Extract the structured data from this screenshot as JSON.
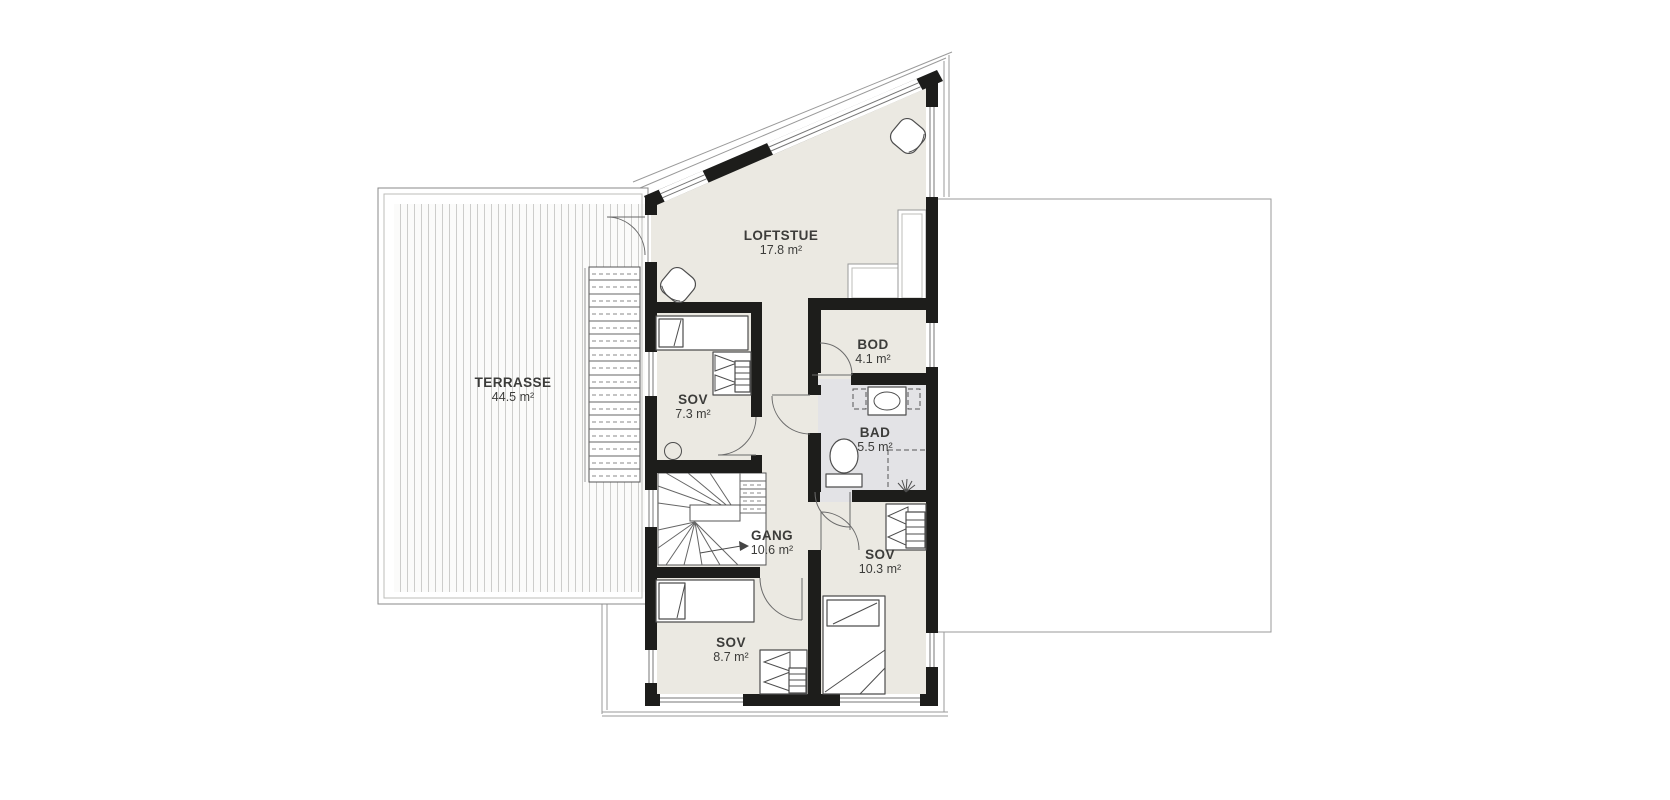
{
  "document": {
    "type": "architectural-floor-plan",
    "floor": "loft / upper floor"
  },
  "rooms": [
    {
      "name": "LOFTSTUE",
      "area": "17.8 m²"
    },
    {
      "name": "TERRASSE",
      "area": "44.5 m²"
    },
    {
      "name": "SOV",
      "area": "7.3 m²"
    },
    {
      "name": "BOD",
      "area": "4.1 m²"
    },
    {
      "name": "BAD",
      "area": "5.5 m²"
    },
    {
      "name": "GANG",
      "area": "10.6 m²"
    },
    {
      "name": "SOV",
      "area": "10.3 m²"
    },
    {
      "name": "SOV",
      "area": "8.7 m²"
    }
  ],
  "icons": {
    "bed-icon": "rectangle with pillow block",
    "wardrobe-icon": "fold-out triangle doors with shelf hatching",
    "toilet-icon": "cistern rectangle + bowl ellipse",
    "washbasin-icon": "cabinet rectangle + oval basin",
    "shower-icon": "dashed enclosure corner + spray lines",
    "stair-icon": "winder stair with fanned treads and direction arrow",
    "door-swing-icon": "quarter-circle swing arc with leaf line",
    "armchair-icon": "rotated rounded square with curved back",
    "ceiling-lamp-icon": "small circle"
  },
  "colors": {
    "wall": "#1d1d1b",
    "floor": "#ebe9e2",
    "bathroom_floor": "#e3e3e6",
    "deck_stripe": "#cdcdcb",
    "outline": "#8a8a8a",
    "furniture_line": "#4d4d4d",
    "door_arc": "#6a6a6a",
    "label_text": "#3c3c3a"
  }
}
